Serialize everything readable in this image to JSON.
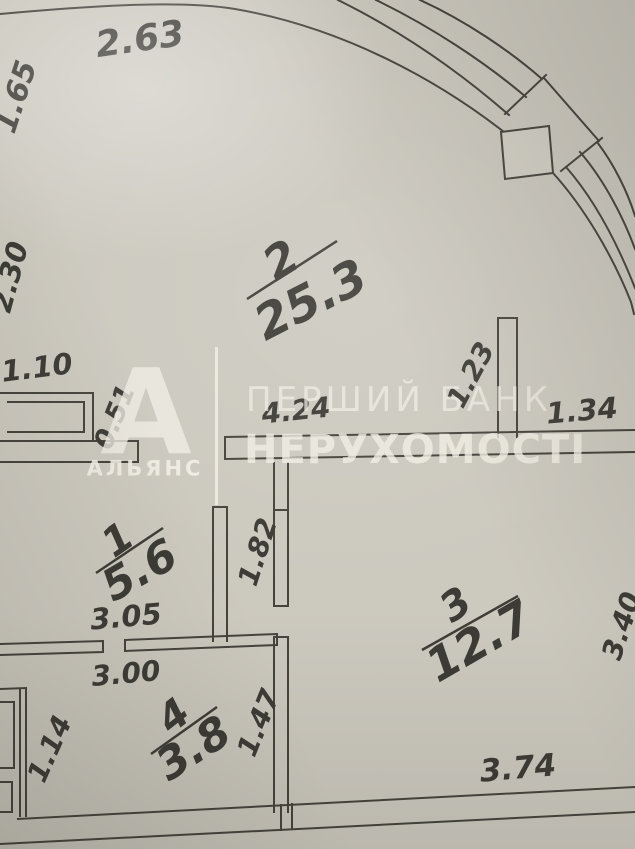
{
  "plan": {
    "rooms": [
      {
        "number": "2",
        "area": "25.3"
      },
      {
        "number": "1",
        "area": "5.6"
      },
      {
        "number": "3",
        "area": "12.7"
      },
      {
        "number": "4",
        "area": "3.8"
      }
    ],
    "dimensions": {
      "top_facade": "2.63",
      "left_upper": "1.65",
      "left_middle": "2.30",
      "window_left": "1.10",
      "wall_pier": "0.51",
      "hall_width": "4.24",
      "wall_stub": "1.23",
      "right_of_stub": "1.34",
      "room1_width": "3.05",
      "corridor": "1.82",
      "room4_width": "3.00",
      "room4_left": "1.14",
      "room4_right": "1.47",
      "room3_bottom": "3.74",
      "room3_right": "3.40"
    },
    "watermark": {
      "brand_letter": "А",
      "brand_name": "АЛЬЯНС",
      "line1": "ПЕРШИЙ БАНК",
      "line2": "НЕРУХОМОСТІ"
    },
    "colors": {
      "paper": "#ccc9bf",
      "ink": "#45443c",
      "watermark": "#efece3"
    }
  }
}
